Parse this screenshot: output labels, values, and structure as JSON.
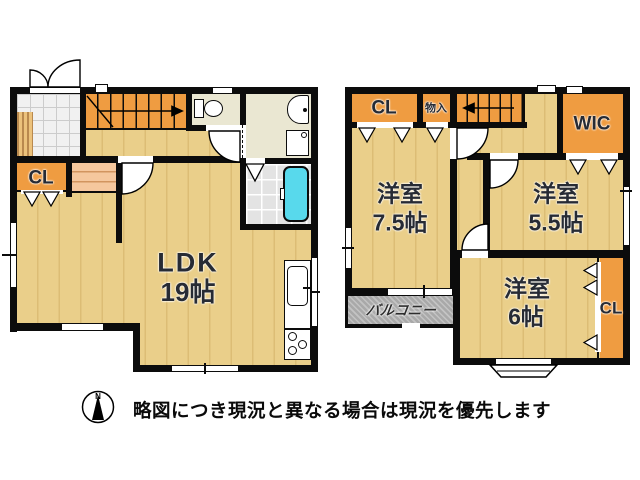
{
  "floor1": {
    "closet_label": "CL",
    "ldk_name": "LDK",
    "ldk_size": "19帖"
  },
  "floor2": {
    "closet_top_label": "CL",
    "storage_label": "物入",
    "wic_label": "WIC",
    "room_a_name": "洋室",
    "room_a_size": "7.5帖",
    "room_b_name": "洋室",
    "room_b_size": "5.5帖",
    "room_c_name": "洋室",
    "room_c_size": "6帖",
    "balcony_label": "バルコニー",
    "closet_side_label": "CL"
  },
  "footer": {
    "compass_n": "N",
    "disclaimer": "略図につき現況と異なる場合は現況を優先します"
  },
  "colors": {
    "wall": "#0c0c0c",
    "wood": "#eacf8a",
    "wood_stripe": "#dcbd75",
    "closet_orange": "#ef9c41",
    "step_peach": "#f5c79d",
    "tile_gray": "#f1f1f1",
    "tile_line": "#cccccc",
    "bath_tile": "#e3e3e3",
    "sanitary_beige": "#eae7d2",
    "bathtub_cyan": "#58d9ec",
    "balcony_gray": "#a9a9a9"
  }
}
